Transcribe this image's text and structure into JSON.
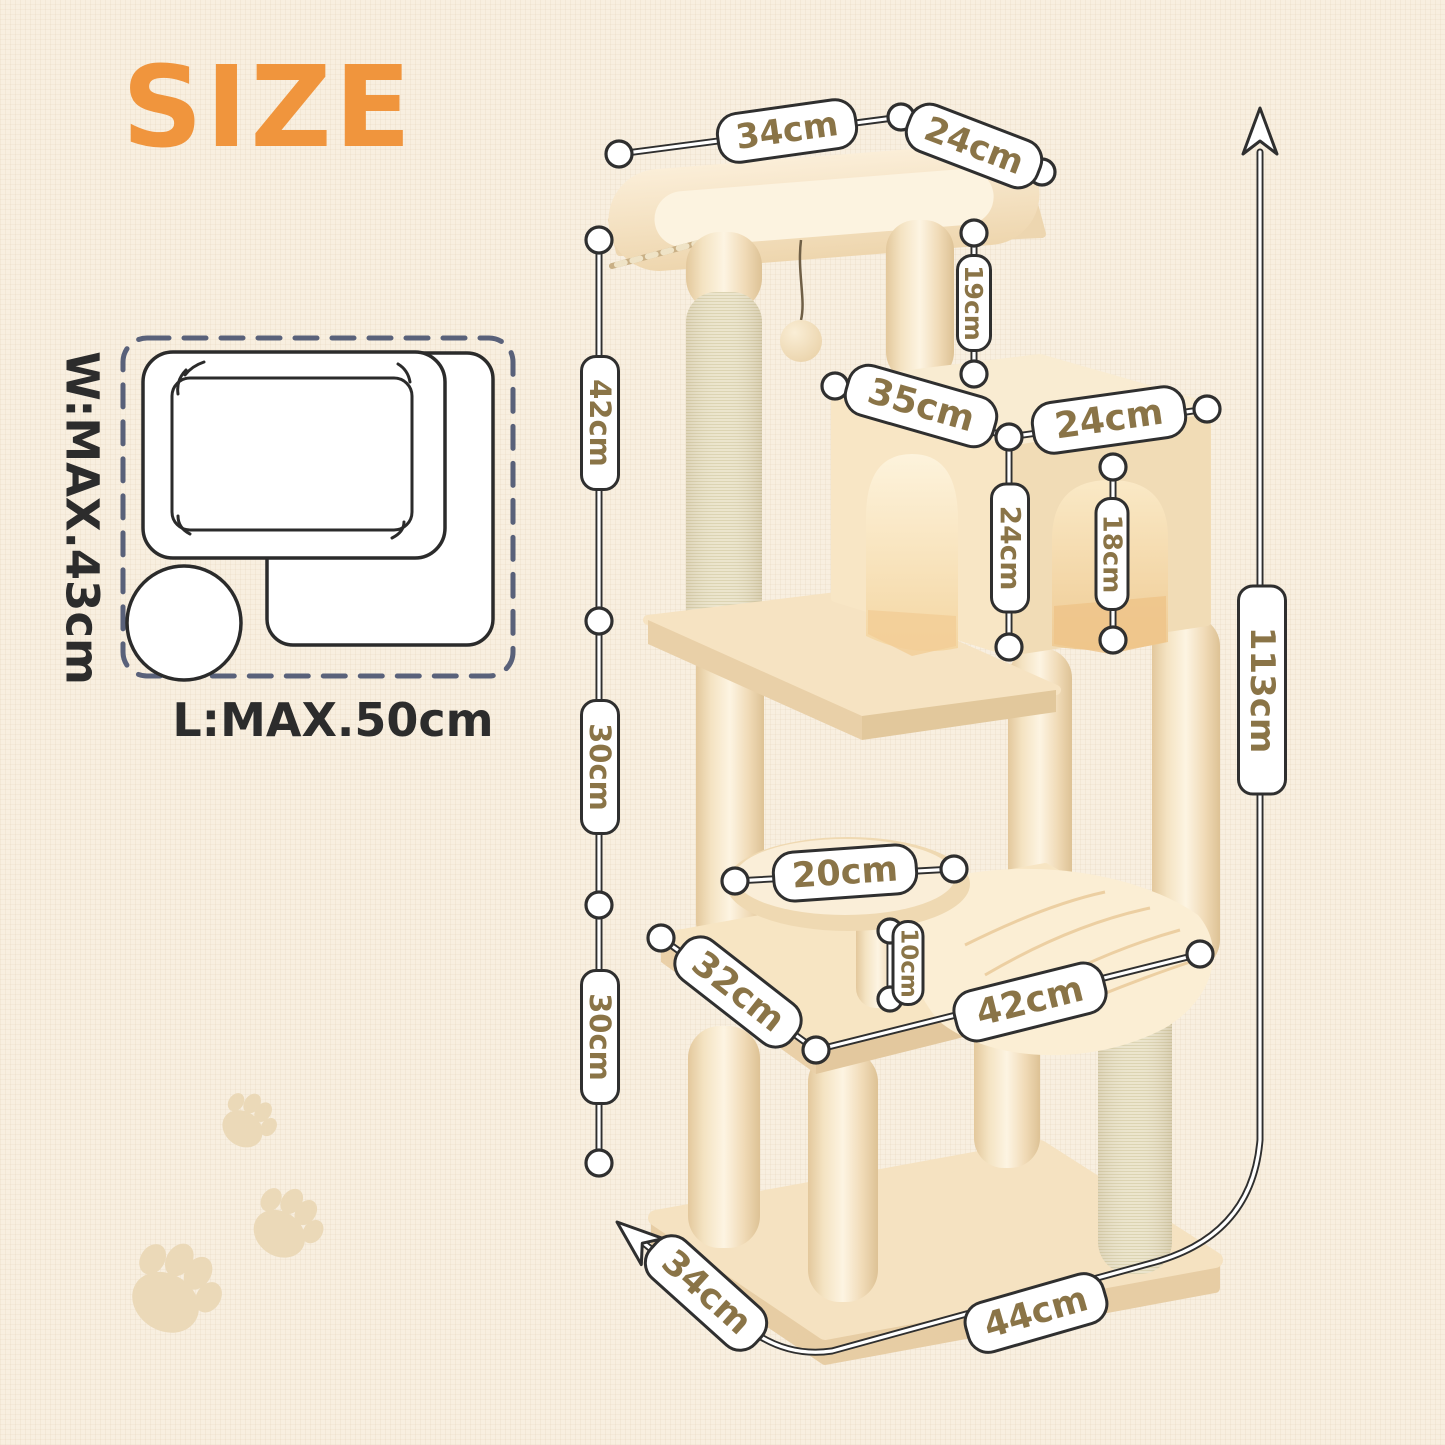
{
  "page": {
    "title": "SIZE"
  },
  "inset": {
    "width_label": "W:MAX.43cm",
    "length_label": "L:MAX.50cm"
  },
  "dims": {
    "top_bed_length": "34cm",
    "top_bed_width": "24cm",
    "top_bed_to_condo": "19cm",
    "condo_length": "35cm",
    "condo_width": "24cm",
    "condo_height": "24cm",
    "condo_door_height": "18cm",
    "section_top": "42cm",
    "section_middle": "30cm",
    "section_bottom": "30cm",
    "total_height": "113cm",
    "stool_diameter": "20cm",
    "stool_post_height": "10cm",
    "hammock_board_side": "32cm",
    "hammock_board_front": "42cm",
    "base_side": "34cm",
    "base_front": "44cm"
  },
  "icons": {
    "height_arrow": "up-arrow",
    "base_direction_arrow": "diagonal-up-left-arrow",
    "paw_prints": "paw-print"
  },
  "colors": {
    "accent_orange": "#F0953D",
    "pill_text": "#8A7447",
    "pill_border": "#2F2F2F",
    "dimension_line": "#2F2F2F",
    "inset_dash_border": "#59617A",
    "inset_line": "#2B2B2B",
    "background": "#F8EFE0",
    "plush_beige": "#F6E4C4",
    "sisal": "#F1EBD6",
    "paw_print": "#EBD9B8"
  }
}
